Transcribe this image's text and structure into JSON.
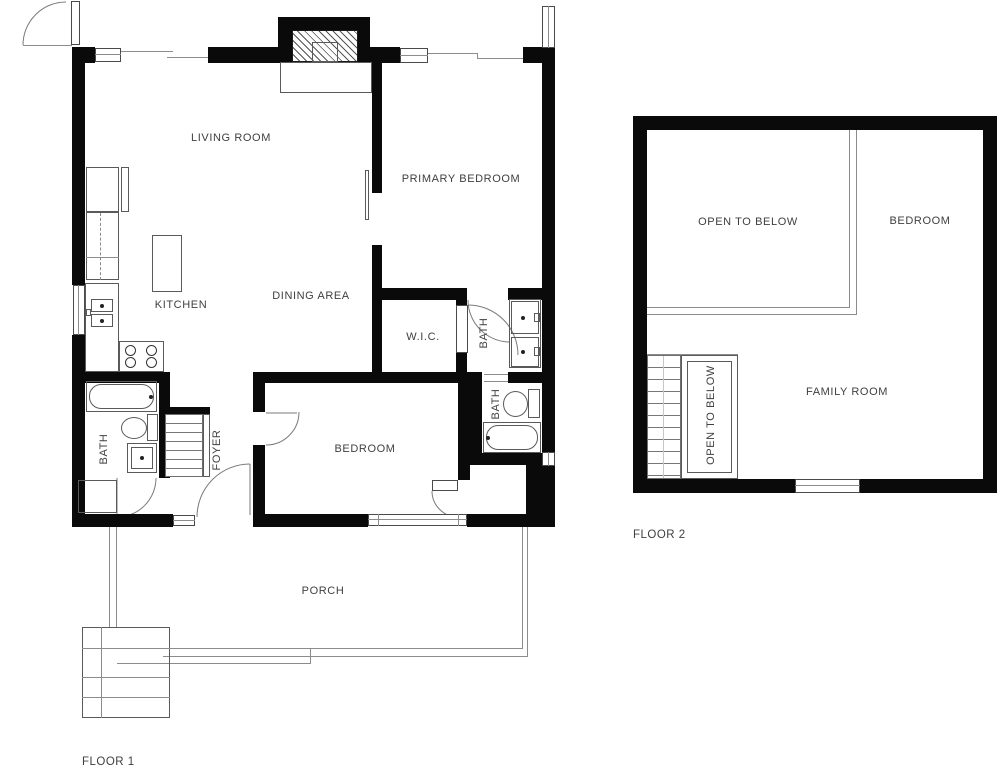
{
  "plan_title": "Two floor residential floor plan",
  "floor1": {
    "label": "FLOOR 1",
    "rooms": {
      "living_room": "LIVING ROOM",
      "primary_bedroom": "PRIMARY BEDROOM",
      "kitchen": "KITCHEN",
      "dining_area": "DINING AREA",
      "wic": "W.I.C.",
      "bath_upper": "BATH",
      "bath_lower": "BATH",
      "bath_left": "BATH",
      "bedroom": "BEDROOM",
      "foyer": "FOYER",
      "porch": "PORCH"
    }
  },
  "floor2": {
    "label": "FLOOR 2",
    "rooms": {
      "open_to_below": "OPEN TO BELOW",
      "bedroom": "BEDROOM",
      "family_room": "FAMILY ROOM",
      "open_to_below_stairs": "OPEN TO BELOW"
    }
  },
  "colors": {
    "wall": "#0a0a0a",
    "thin_line": "#8c8c8c",
    "label": "#3f3f3f",
    "background": "#ffffff"
  }
}
